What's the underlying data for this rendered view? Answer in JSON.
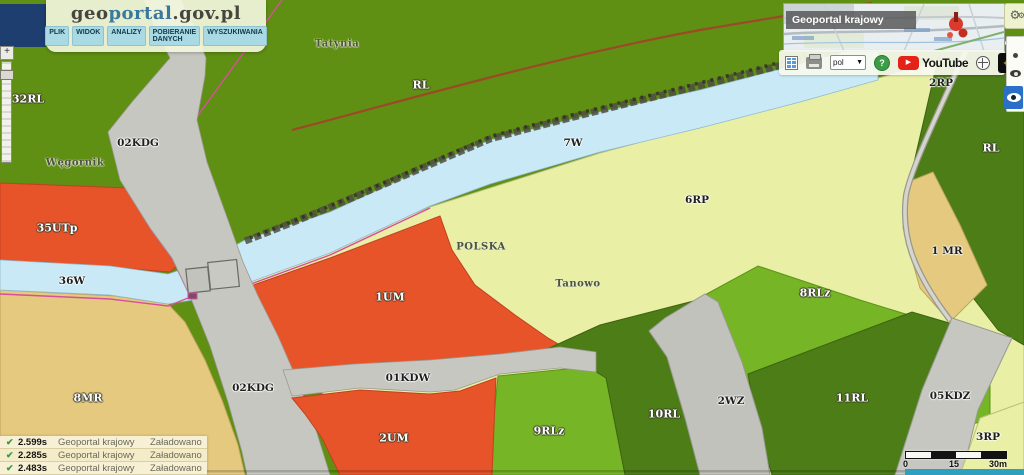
{
  "header": {
    "logo": {
      "part1": "geo",
      "part2": "portal",
      "part3": ".gov.pl"
    },
    "menu_items": [
      "PLIK",
      "WIDOK",
      "ANALIZY",
      "POBIERANIE DANYCH",
      "WYSZUKIWANIA"
    ]
  },
  "overview_map": {
    "title": "Geoportal krajowy"
  },
  "toolbar": {
    "language_value": "pol",
    "youtube_label": "YouTube",
    "icons": {
      "report-icon": "grid",
      "print-icon": "printer",
      "language-caret": "▼",
      "help-icon": "?",
      "youtube-play": "▶",
      "globe-icon": "circle-cross",
      "eye-plus": "+",
      "gears-icon": "⚙",
      "zoom-plus": "+"
    }
  },
  "map": {
    "labels": [
      {
        "text": "32RL",
        "x": 28,
        "y": 99,
        "style": "light"
      },
      {
        "text": "Węgornik",
        "x": 75,
        "y": 163,
        "style": "place"
      },
      {
        "text": "02KDG",
        "x": 138,
        "y": 143,
        "style": "dark"
      },
      {
        "text": "35UTp",
        "x": 57,
        "y": 228,
        "style": "light"
      },
      {
        "text": "36W",
        "x": 72,
        "y": 281,
        "style": "dark"
      },
      {
        "text": "8MR",
        "x": 88,
        "y": 398,
        "style": "light"
      },
      {
        "text": "Tatynia",
        "x": 337,
        "y": 44,
        "style": "place"
      },
      {
        "text": "RL",
        "x": 421,
        "y": 85,
        "style": "light"
      },
      {
        "text": "1UM",
        "x": 390,
        "y": 297,
        "style": "light"
      },
      {
        "text": "POLSKA",
        "x": 481,
        "y": 247,
        "style": "place"
      },
      {
        "text": "2UM",
        "x": 394,
        "y": 438,
        "style": "light"
      },
      {
        "text": "02KDG",
        "x": 253,
        "y": 388,
        "style": "dark"
      },
      {
        "text": "01KDW",
        "x": 408,
        "y": 378,
        "style": "dark"
      },
      {
        "text": "9RLz",
        "x": 549,
        "y": 431,
        "style": "light"
      },
      {
        "text": "Tanowo",
        "x": 578,
        "y": 284,
        "style": "place"
      },
      {
        "text": "7W",
        "x": 573,
        "y": 143,
        "style": "dark"
      },
      {
        "text": "6RP",
        "x": 697,
        "y": 200,
        "style": "dark"
      },
      {
        "text": "10RL",
        "x": 664,
        "y": 414,
        "style": "light"
      },
      {
        "text": "2WZ",
        "x": 731,
        "y": 401,
        "style": "dark"
      },
      {
        "text": "8RLz",
        "x": 815,
        "y": 293,
        "style": "light"
      },
      {
        "text": "11RL",
        "x": 852,
        "y": 398,
        "style": "light"
      },
      {
        "text": "2RP",
        "x": 941,
        "y": 83,
        "style": "dark"
      },
      {
        "text": "RL",
        "x": 991,
        "y": 148,
        "style": "light"
      },
      {
        "text": "1 MR",
        "x": 947,
        "y": 251,
        "style": "dark"
      },
      {
        "text": "05KDZ",
        "x": 950,
        "y": 396,
        "style": "dark"
      },
      {
        "text": "3RP",
        "x": 988,
        "y": 437,
        "style": "dark"
      }
    ]
  },
  "status_log": {
    "rows": [
      {
        "check": "✔",
        "time": "2.599s",
        "source": "Geoportal krajowy",
        "status": "Załadowano"
      },
      {
        "check": "✔",
        "time": "2.285s",
        "source": "Geoportal krajowy",
        "status": "Załadowano"
      },
      {
        "check": "✔",
        "time": "2.483s",
        "source": "Geoportal krajowy",
        "status": "Załadowano"
      }
    ]
  },
  "scale_bar": {
    "ticks": [
      "0",
      "15",
      "30m"
    ]
  },
  "colors": {
    "forest_olive": "#5f8f13",
    "bright_green": "#76b525",
    "dark_green": "#4c7d17",
    "orange_zone": "#e8542a",
    "pale_yellow": "#e9efa4",
    "tan_zone": "#e5c97f",
    "water_blue": "#c9e9f6",
    "road_gray": "#c7c7c1",
    "boundary_magenta": "#d84f9f",
    "boundary_brown": "#9c4a26",
    "menu_blue": "#a9d9e3",
    "header_cream": "#f2f6de",
    "blue_button": "#2a70c8",
    "eye_yellow": "#f0cf00",
    "teal_strip": "#2f9fc0"
  }
}
